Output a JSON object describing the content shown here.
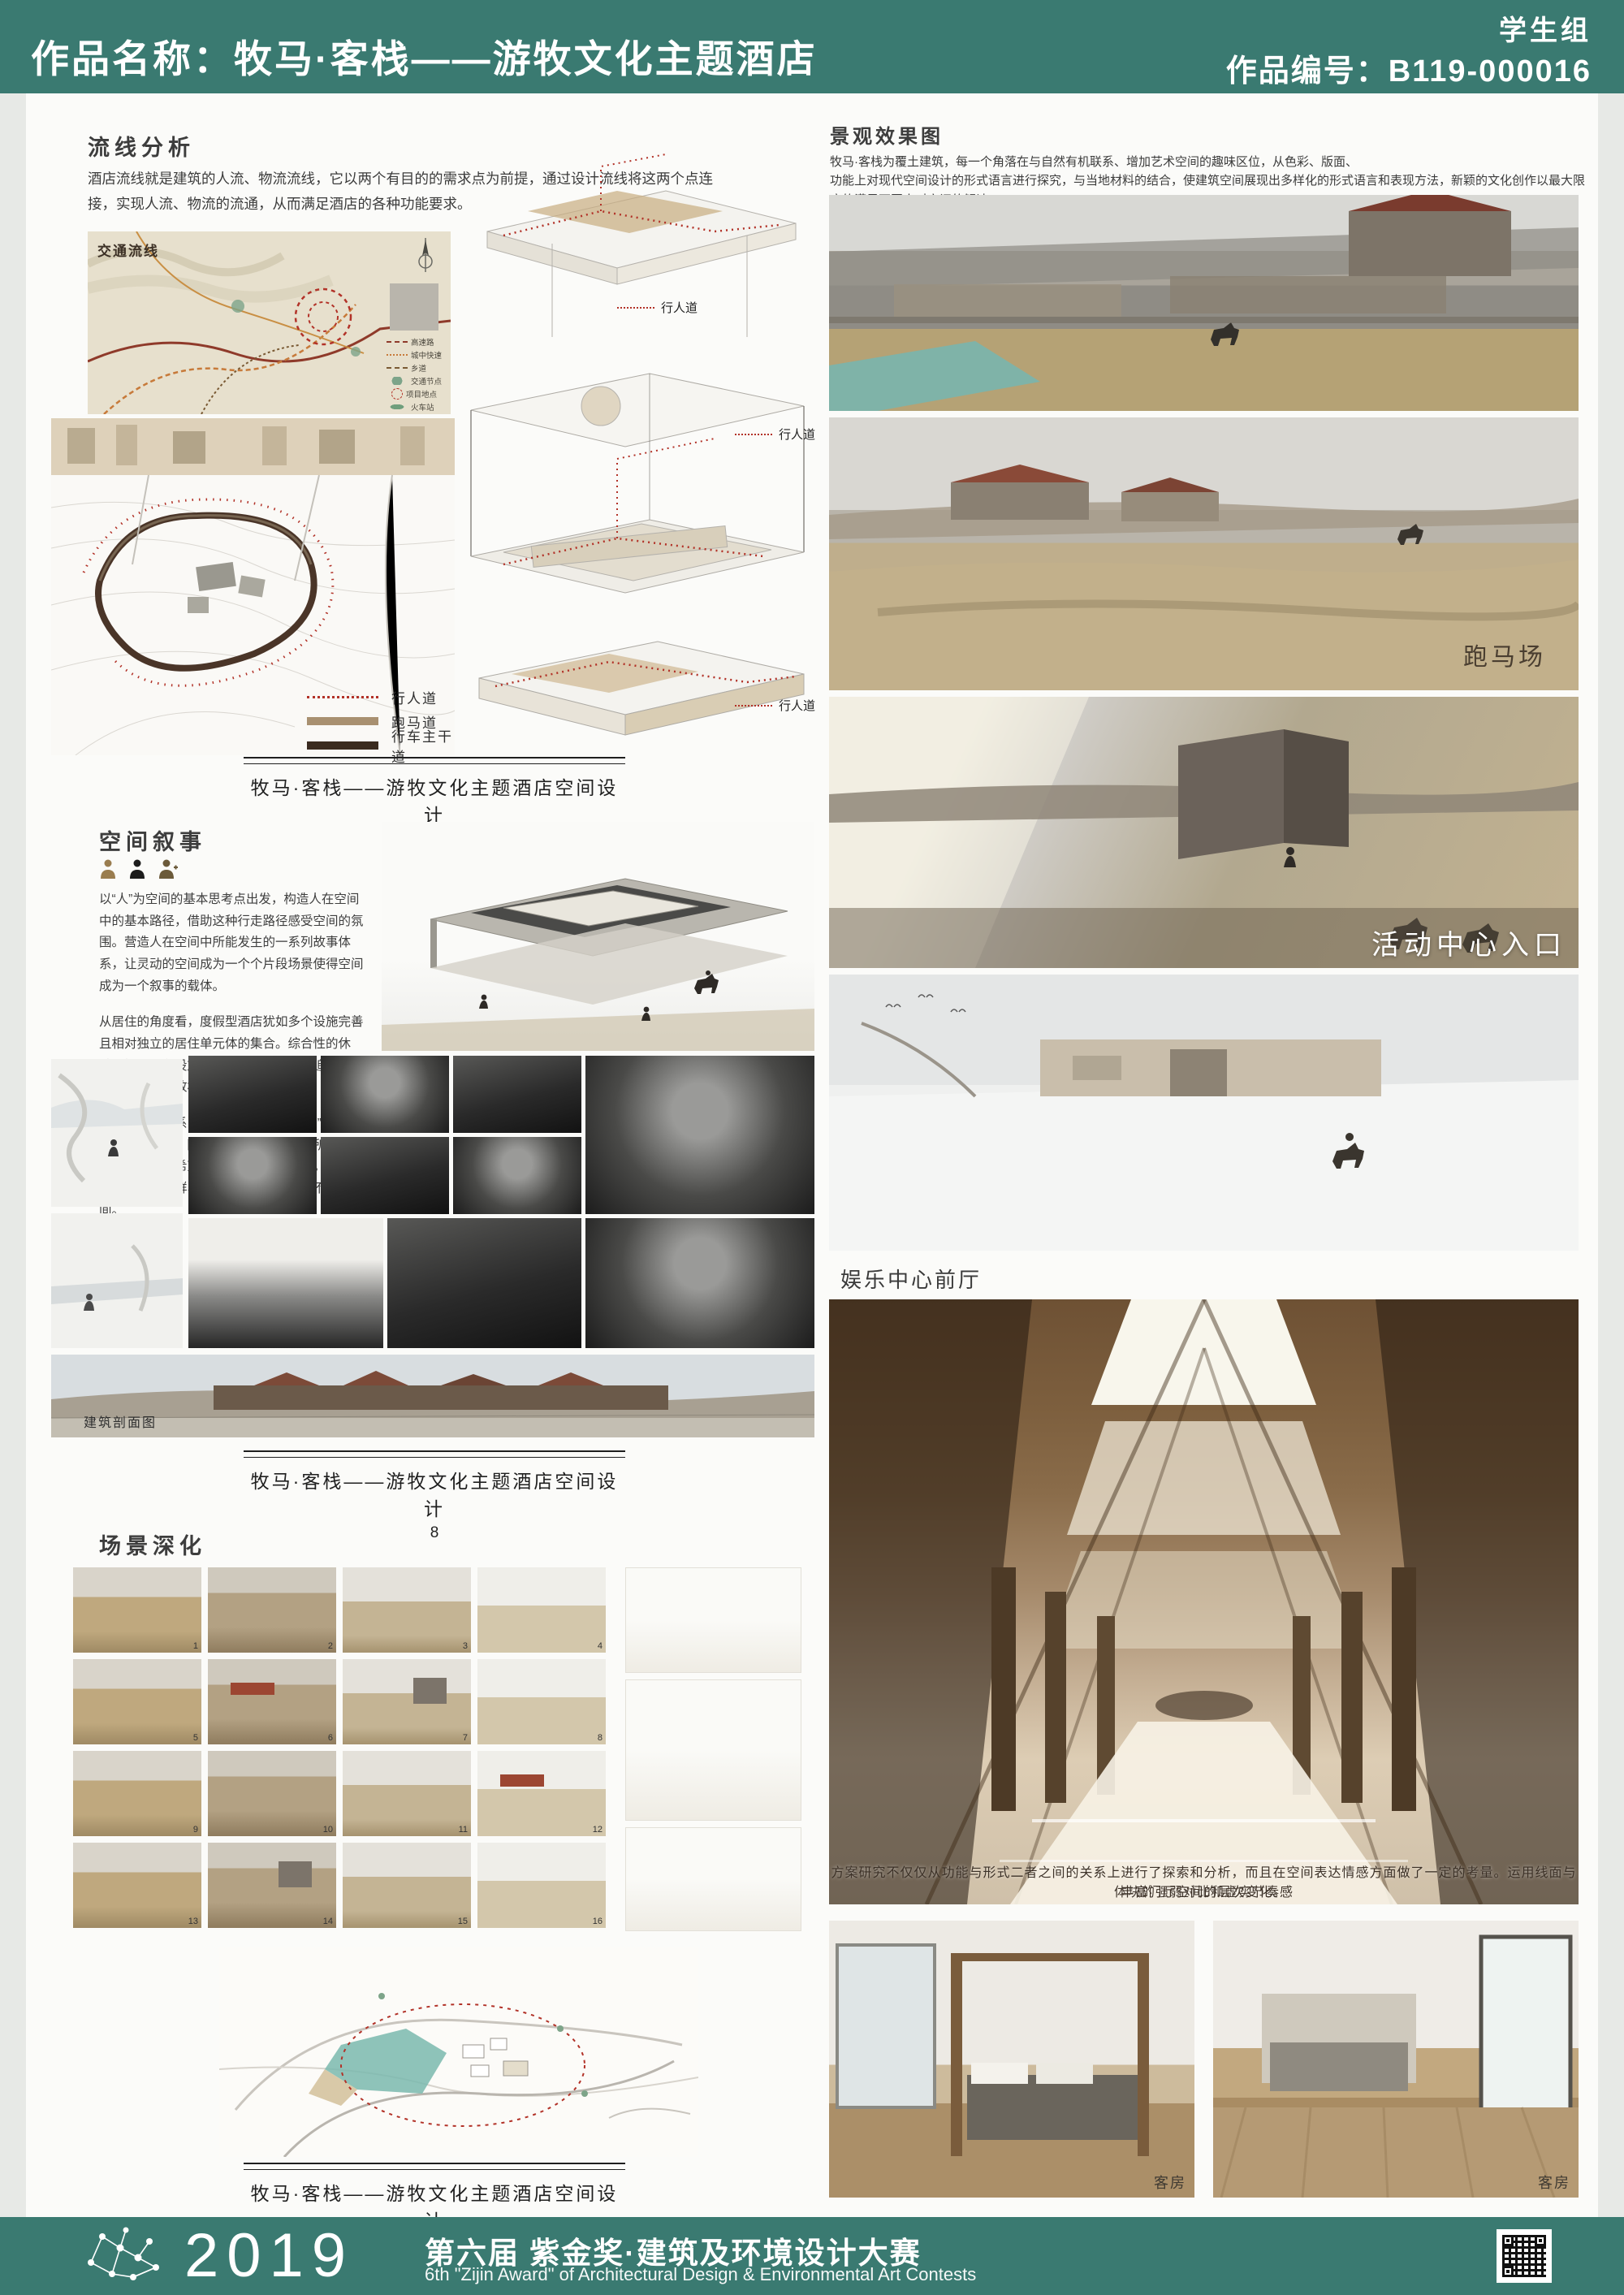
{
  "header": {
    "title": "作品名称：牧马·客栈——游牧文化主题酒店",
    "group": "学生组",
    "number": "作品编号：B119-000016"
  },
  "left": {
    "flow_heading": "流线分析",
    "flow_text": "酒店流线就是建筑的人流、物流流线，它以两个有目的的需求点为前提，通过设计流线将这两个点连接，实现人流、物流的流通，从而满足酒店的各种功能要求。",
    "map_title": "交通流线",
    "map_legend": [
      "高速路",
      "城中快速",
      "乡道",
      "交通节点",
      "项目地点",
      "火车站",
      "飞机场"
    ],
    "walkway_label": "行人道",
    "plan_legend": [
      {
        "label": "行人道"
      },
      {
        "label": "跑马道"
      },
      {
        "label": "行车主干道"
      }
    ],
    "captions": [
      {
        "title": "牧马·客栈——游牧文化主题酒店空间设计",
        "page": "7"
      },
      {
        "title": "牧马·客栈——游牧文化主题酒店空间设计",
        "page": "8"
      },
      {
        "title": "牧马·客栈——游牧文化主题酒店空间设计",
        "page": "9"
      }
    ],
    "narrative_heading": "空间叙事",
    "narrative_p1": "以“人”为空间的基本思考点出发，构造人在空间中的基本路径，借助这种行走路径感受空间的氛围。营造人在空间中所能发生的一系列故事体系，让灵动的空间成为一个个片段场景使得空间成为一个叙事的载体。",
    "narrative_p2": "从居住的角度看，度假型酒店犹如多个设施完善且相对独立的居住单元体的集合。综合性的休憩、娱乐服务设施在度假型酒店人们所追求的是身心的愉悦和放松。",
    "narrative_p3": "人与空间的关系：度假酒店是一个让“人”身心愉悦，修身阳性、陶冶情操的世外桃源，所以来到这里的顾客都希望得到最好的精神享受。我们根据不同消费人群、不同目的的顾客制定不同的空间。",
    "section_label": "建筑剖面图",
    "scenes_heading": "场景深化",
    "scene_numbers": [
      "1",
      "2",
      "3",
      "4",
      "5",
      "6",
      "7",
      "8",
      "9",
      "10",
      "11",
      "12",
      "13",
      "14",
      "15",
      "16"
    ]
  },
  "right": {
    "heading": "景观效果图",
    "intro_1": "牧马·客栈为覆土建筑，每一个角落在与自然有机联系、增加艺术空间的趣味区位，从色彩、版面、",
    "intro_2": "功能上对现代空间设计的形式语言进行探究，与当地材料的结合，使建筑空间展现出多样化的形式语言和表现方法，新颖的文化创作以最大限度的满足不同人对空间的解读。",
    "racetrack_label": "跑马场",
    "entrance_label": "活动中心入口",
    "lobby_label": "娱乐中心前厅",
    "note_1": "方案研究不仅仅从功能与形式二者之间的关系上进行了探索和分析，而且在空间表达情感方面做了一定的考量。运用线面与体块的强弱对比和虚实节奏感",
    "note_2": "丰富门厅空间的层次变化。",
    "room_label": "客房"
  },
  "footer": {
    "year": "2019",
    "title_cn": "第六届 紫金奖·建筑及环境设计大赛",
    "title_en": "6th \"Zijin Award\" of Architectural Design & Environmental Art Contests"
  },
  "colors": {
    "brand_teal": "#3a7a71",
    "accent_red": "#b23228",
    "road_brown": "#3a2b20",
    "track_tan": "#a89070"
  }
}
